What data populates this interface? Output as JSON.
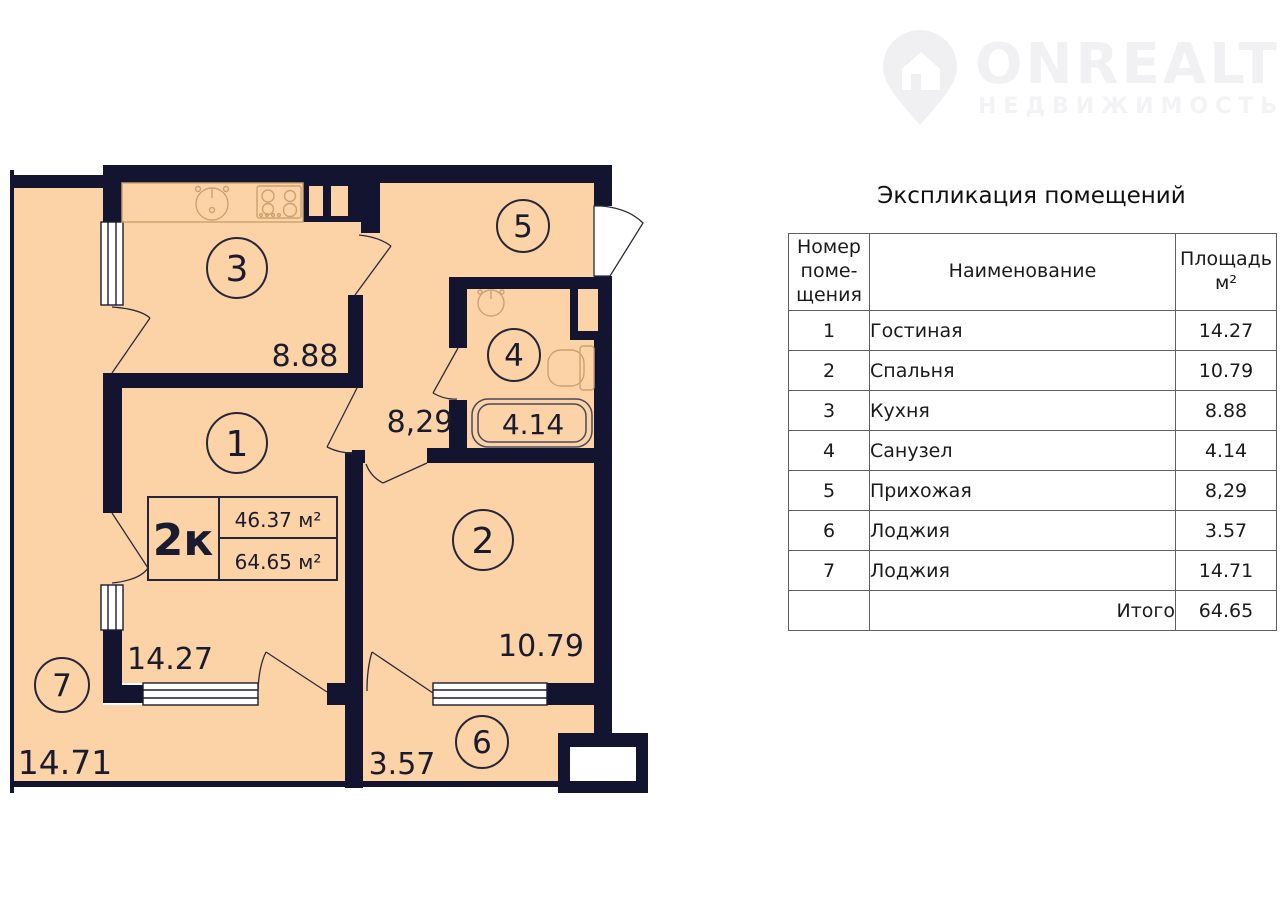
{
  "logo": {
    "brand": "ONREALT",
    "tagline": "НЕДВИЖИМОСТЬ"
  },
  "plan": {
    "type_label": "2к",
    "living_area": "46.37 м²",
    "total_area": "64.65 м²",
    "rooms": [
      {
        "num": "1",
        "area": "14.27"
      },
      {
        "num": "2",
        "area": "10.79"
      },
      {
        "num": "3",
        "area": "8.88"
      },
      {
        "num": "4",
        "area": "4.14"
      },
      {
        "num": "5",
        "area": "8,29"
      },
      {
        "num": "6",
        "area": "3.57"
      },
      {
        "num": "7",
        "area": "14.71"
      }
    ]
  },
  "table": {
    "title": "Экспликация помещений",
    "headers": {
      "number": "Номер\nпоме-\nщения",
      "name": "Наименование",
      "area": "Площадь\nм²"
    },
    "rows": [
      {
        "num": "1",
        "name": "Гостиная",
        "area": "14.27"
      },
      {
        "num": "2",
        "name": "Спальня",
        "area": "10.79"
      },
      {
        "num": "3",
        "name": "Кухня",
        "area": "8.88"
      },
      {
        "num": "4",
        "name": "Санузел",
        "area": "4.14"
      },
      {
        "num": "5",
        "name": "Прихожая",
        "area": "8,29"
      },
      {
        "num": "6",
        "name": "Лоджия",
        "area": "3.57"
      },
      {
        "num": "7",
        "name": "Лоджия",
        "area": "14.71"
      }
    ],
    "total_label": "Итого",
    "total_value": "64.65"
  },
  "colors": {
    "wall": "#131530",
    "floor": "#fbd3a6",
    "fixture": "#c9a36f",
    "line": "#2a2a3e"
  }
}
